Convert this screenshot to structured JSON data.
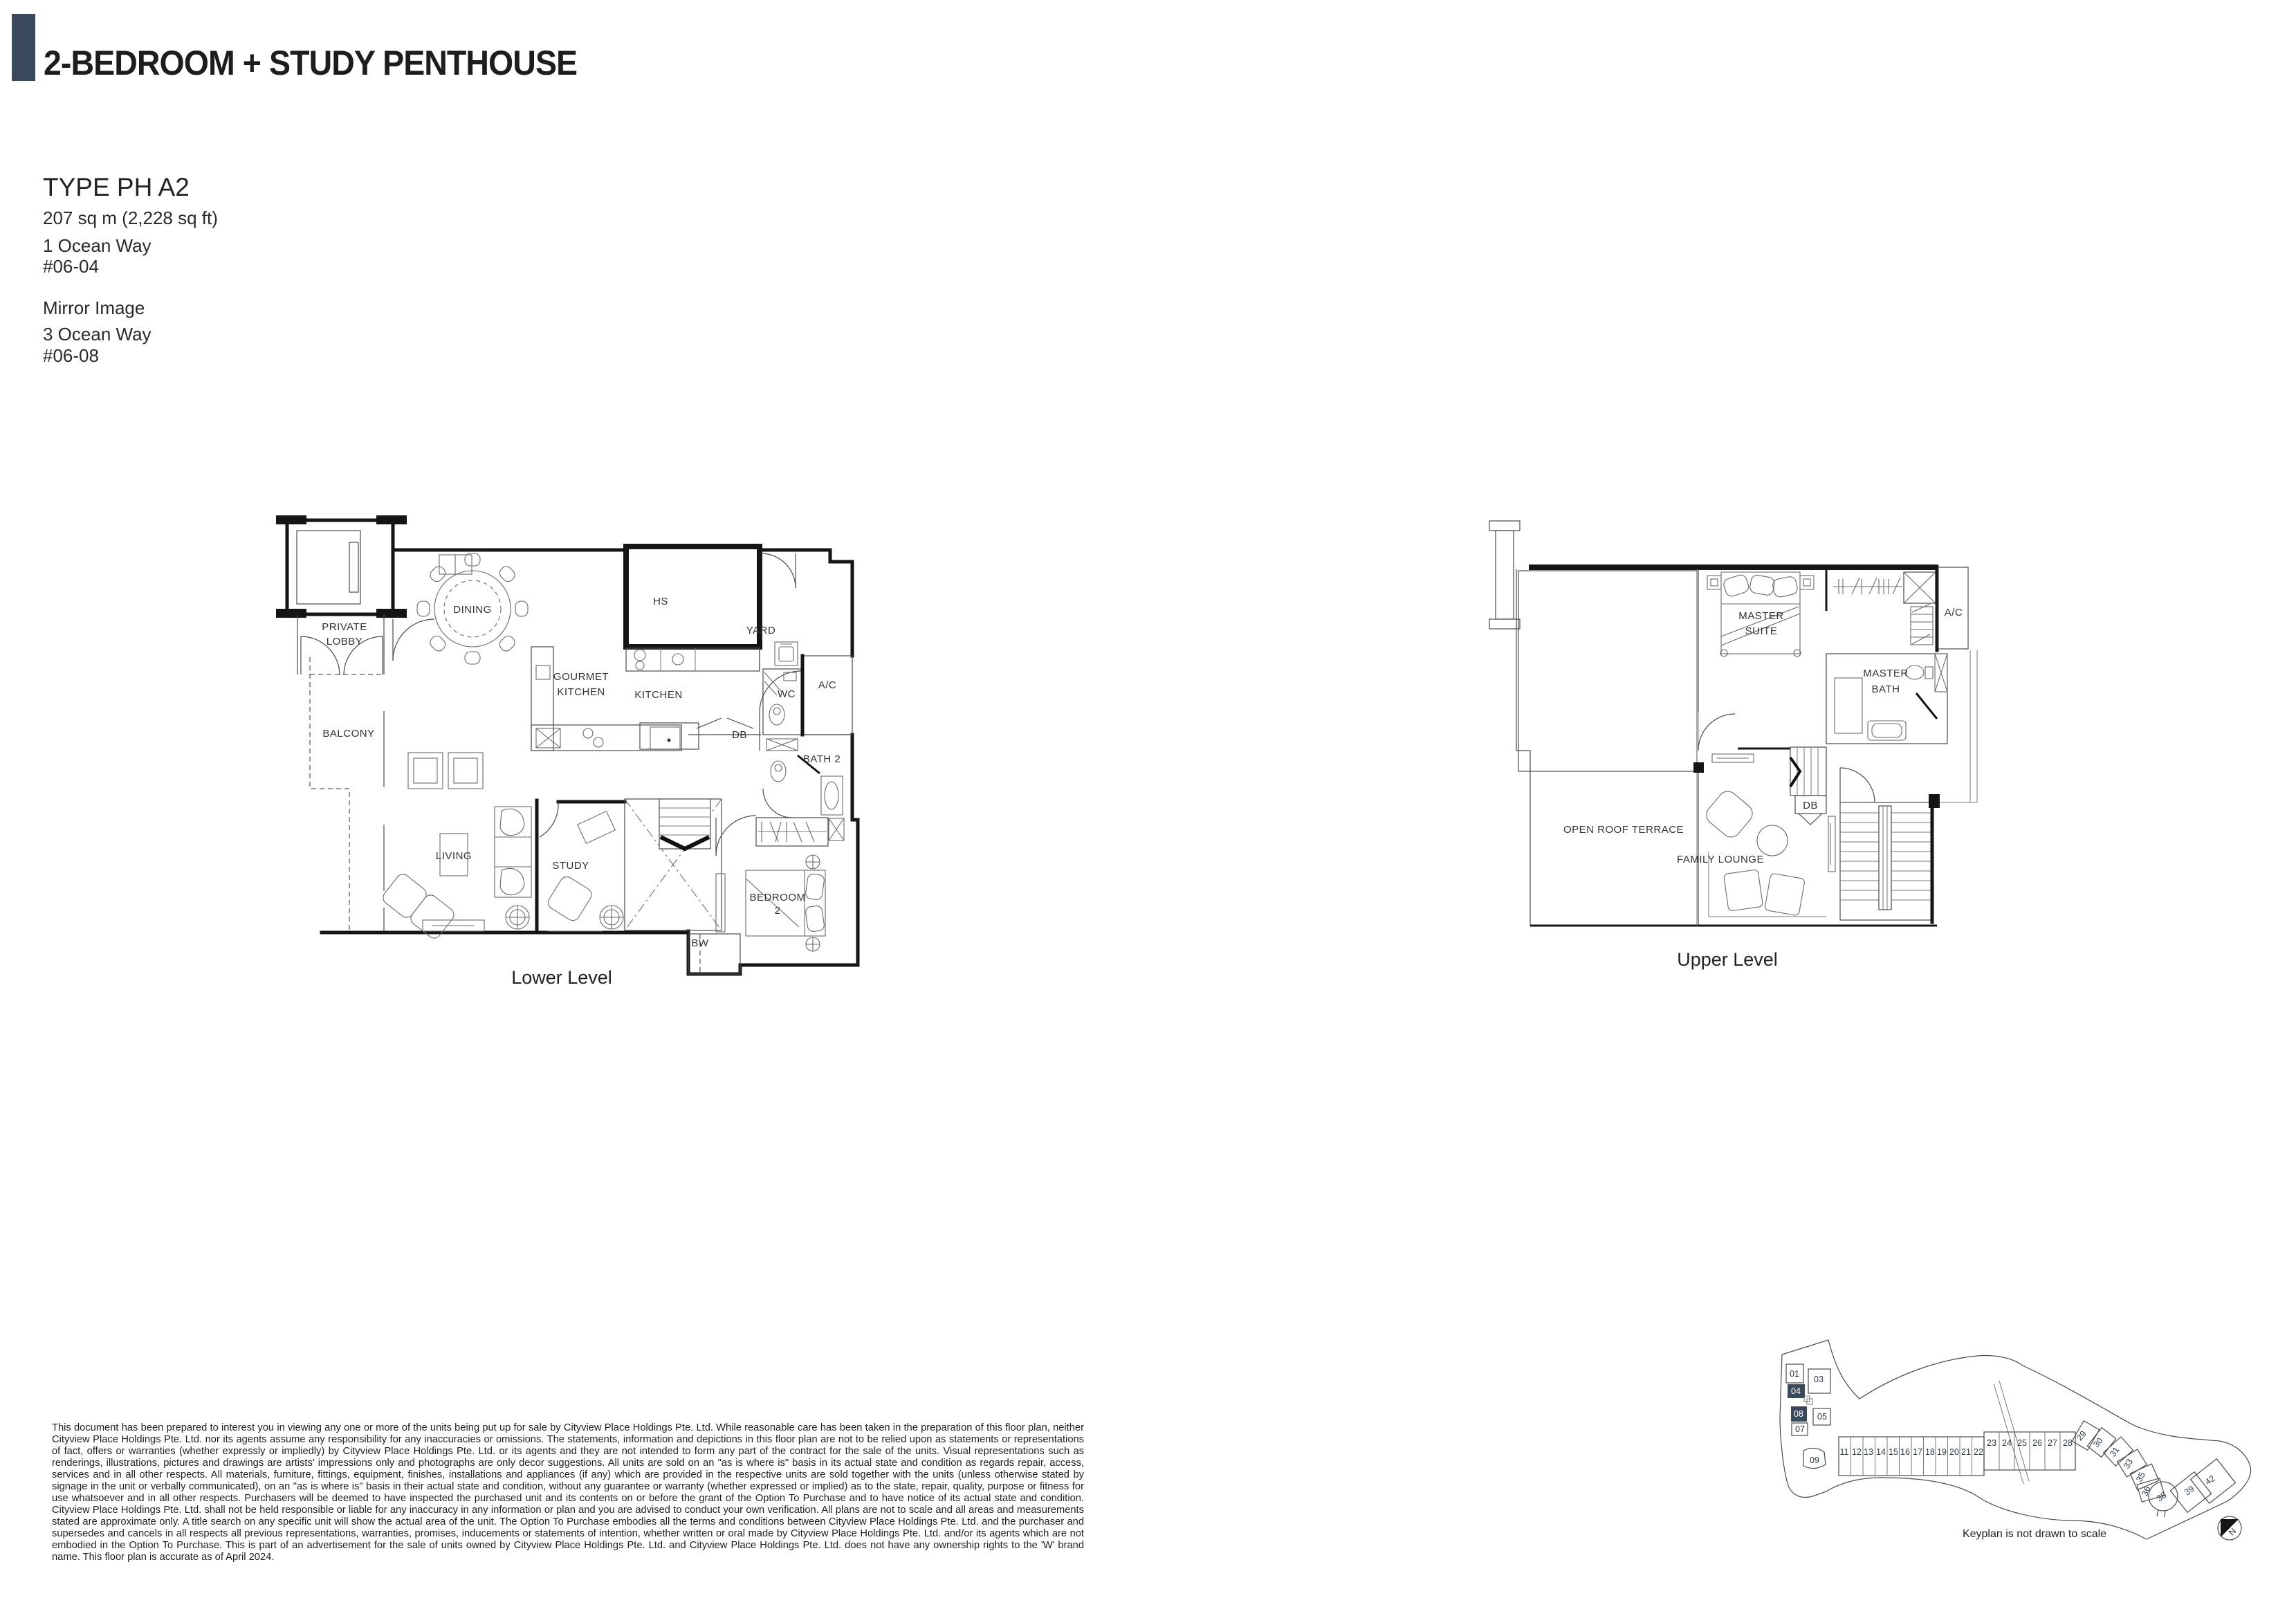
{
  "header": {
    "title": "2-BEDROOM + STUDY PENTHOUSE",
    "accent_color": "#3a4a5c"
  },
  "unit_info": {
    "type_label": "TYPE PH A2",
    "area": "207 sq m (2,228 sq ft)",
    "unit_1_address": "1 Ocean Way",
    "unit_1_number": "#06-04",
    "mirror_label": "Mirror Image",
    "unit_2_address": "3 Ocean Way",
    "unit_2_number": "#06-08"
  },
  "lower_level": {
    "caption": "Lower Level",
    "labels": {
      "private_lobby_line1": "PRIVATE",
      "private_lobby_line2": "LOBBY",
      "dining": "DINING",
      "hs": "HS",
      "yard": "YARD",
      "gourmet_line1": "GOURMET",
      "gourmet_line2": "KITCHEN",
      "kitchen": "KITCHEN",
      "wc": "WC",
      "ac": "A/C",
      "db": "DB",
      "bath2": "BATH 2",
      "balcony": "BALCONY",
      "living": "LIVING",
      "study": "STUDY",
      "bedroom2_line1": "BEDROOM",
      "bedroom2_line2": "2",
      "bw": "BW"
    }
  },
  "upper_level": {
    "caption": "Upper Level",
    "labels": {
      "master_suite_line1": "MASTER",
      "master_suite_line2": "SUITE",
      "ac": "A/C",
      "master_bath_line1": "MASTER",
      "master_bath_line2": "BATH",
      "open_roof_terrace": "OPEN ROOF TERRACE",
      "db": "DB",
      "family_lounge": "FAMILY LOUNGE"
    }
  },
  "disclaimer": "This document has been prepared to interest you in viewing any one or more of the units being put up for sale by Cityview Place Holdings Pte. Ltd. While reasonable care has been taken in the preparation of this floor plan, neither Cityview Place Holdings Pte. Ltd. nor its agents assume any responsibility for any inaccuracies or omissions. The statements, information and depictions in this floor plan are not to be relied upon as statements or representations of fact, offers or warranties (whether expressly or impliedly) by Cityview Place Holdings Pte. Ltd. or its agents and they are not intended to form any part of the contract for the sale of the units. Visual representations such as renderings, illustrations, pictures and drawings are artists' impressions only and photographs are only decor suggestions. All units are sold on an \"as is where is\" basis in its actual state and condition as regards repair, access, services and in all other respects. All materials, furniture, fittings, equipment, finishes, installations and appliances (if any) which are provided in the respective units are sold together with the units (unless otherwise stated by signage in the unit or verbally communicated), on an \"as is where is\" basis in their actual state and condition, without any guarantee or warranty (whether expressed or implied) as to the state, repair, quality, purpose or fitness for use whatsoever and in all other respects. Purchasers will be deemed to have inspected the purchased unit and its contents on or before the grant of the Option To Purchase and to have notice of its actual state and condition. Cityview Place Holdings Pte. Ltd. shall not be held responsible or liable for any inaccuracy in any information or plan and you are advised to conduct your own verification. All plans are not to scale and all areas and measurements stated are approximate only. A title search on any specific unit will show the actual area of the unit. The Option To Purchase embodies all the terms and conditions between Cityview Place Holdings Pte. Ltd. and the purchaser and supersedes and cancels in all respects all previous representations, warranties, promises, inducements or statements of intention, whether written or oral made by Cityview Place Holdings Pte. Ltd. and/or its agents which are not embodied in the Option To Purchase. This is part of an advertisement for the sale of units owned by Cityview Place Holdings Pte. Ltd. and Cityview Place Holdings Pte. Ltd. does not have any ownership rights to the 'W' brand name. This floor plan is accurate as of April 2024.",
  "keyplan": {
    "caption": "Keyplan is not drawn to scale",
    "north_label": "N",
    "units": [
      "01",
      "03",
      "04",
      "05",
      "07",
      "08",
      "09",
      "11",
      "12",
      "13",
      "14",
      "15",
      "16",
      "17",
      "18",
      "19",
      "20",
      "21",
      "22",
      "23",
      "24",
      "25",
      "26",
      "27",
      "28",
      "29",
      "30",
      "31",
      "33",
      "35",
      "36",
      "38",
      "39",
      "42"
    ],
    "highlighted_units": [
      "04",
      "08"
    ]
  }
}
